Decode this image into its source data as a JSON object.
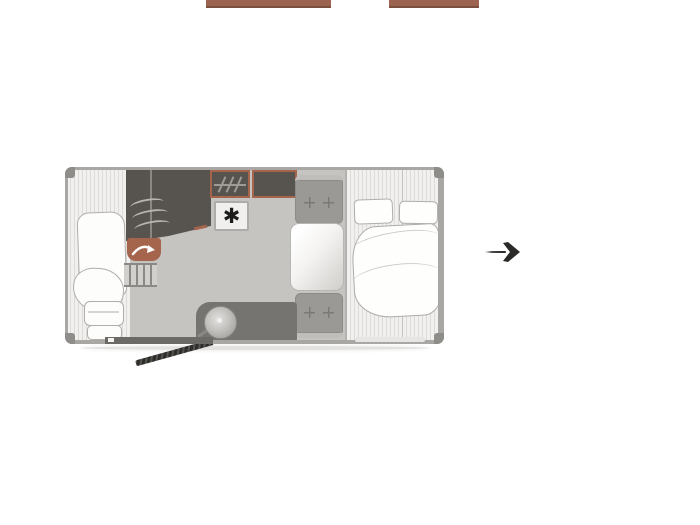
{
  "canvas": {
    "background": "#ffffff",
    "width": 700,
    "height": 525
  },
  "floorplan": {
    "subject": "caravan-floor-plan",
    "colors": {
      "accent_brown": "#a5644c",
      "unit_dark": "#57534e",
      "floor_gray": "#c6c4c1",
      "washroom_gray": "#767471",
      "seat_gray": "#9b9996",
      "wall_gray": "#a9a7a4",
      "stripe_bg": "#f1f0ee",
      "stripe_line": "#dcdbd9",
      "soft_furnishing_white": "#fdfdfc",
      "hitch_dark": "#2e2d2b",
      "cropped_bar_brown": "#9c6450"
    },
    "areas": {
      "front_lounge": "front-lounge-with-cushions",
      "kitchen": "kitchen-unit-with-hob",
      "wardrobe": "wardrobe-with-hanging-rail",
      "overhead_cabinet": "cabinet-unit",
      "fridge": "fridge",
      "washroom": "washroom-with-round-sink",
      "dinette": "two-seat-dinette-with-table",
      "bedroom": "fixed-double-bed-with-pillows-and-duvet"
    },
    "icons": {
      "fridge_glyph": "✱",
      "fridge_icon": "snowflake-icon",
      "hob_icon": "burner-arc-icon",
      "wardrobe_icon": "hanging-rail-icon",
      "swivel_icon": "curved-arrow-icon",
      "sink_icon": "round-sink-with-tap-icon",
      "entry_icon": "entry-arrow-icon",
      "hitch_icon": "tow-hitch-bar-icon"
    }
  }
}
